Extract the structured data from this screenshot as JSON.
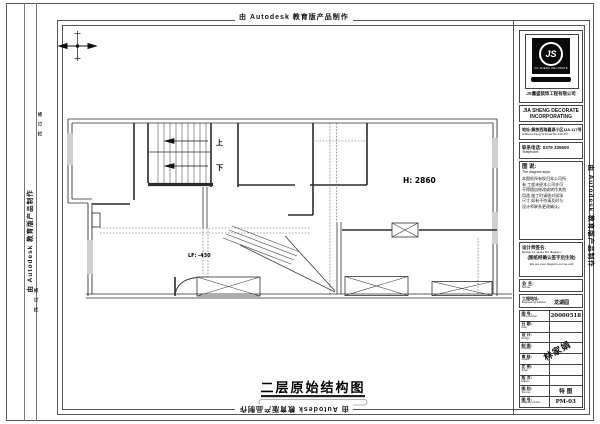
{
  "banner": {
    "autodesk": "由 Autodesk 教育版产品制作"
  },
  "margin": {
    "revision_top": "修 订 栏",
    "revision_bottom": "修 订 栏"
  },
  "plan": {
    "stair_up": "上",
    "stair_down": "下",
    "height_label": "H: 2860",
    "level_label": "LF: -430",
    "title": "二层原始结构图"
  },
  "title_block": {
    "logo": {
      "monogram": "JS",
      "sub": "JIA SHENG DECORATE",
      "company_cn": "JS嘉盛装饰工程有限公司"
    },
    "company_en_line1": "JIA SHENG DECORATE",
    "company_en_line2": "INCORPORATING",
    "address_cn": "地址:解放西路鑫源小区118-117号",
    "address_en": "Address:Fang W  Road No.118-117",
    "phone_cn": "联系电话: 0379 335500",
    "phone_en": "Telephone:",
    "notes_title_cn": "图 说:",
    "notes_title_en": "The diagram says:",
    "notes_lines": [
      "本图纸所有权归本公司所",
      "有,工程未经本公司许可",
      "不得擅自修改或转作其他",
      "用途,施工时请核对现场",
      "尺寸,如有不符请及时与",
      "设计师联系更改确认。"
    ],
    "sign_title_cn": "设计师签名:",
    "sign_title_en": "Design for about the diagram:",
    "sign_bold": "(图纸经确认签字后生效)",
    "sign_small": "We are over diagram our we and",
    "owner_label_cn": "业 主:",
    "owner_label_en": "Name:",
    "owner_value": "",
    "site_label_cn": "工程地址:",
    "site_label_en": "Engineering address:",
    "site_value": "龙湖园",
    "stamp": "林家娟",
    "table_rows": [
      {
        "cn": "图 号:",
        "en": "Plans number:",
        "value": "20000518"
      },
      {
        "cn": "日 期:",
        "en": "Date:",
        "value": ""
      },
      {
        "cn": "设 计:",
        "en": "Design:",
        "value": ""
      },
      {
        "cn": "制 图:",
        "en": "Drawing:",
        "value": ""
      },
      {
        "cn": "审 核:",
        "en": "Auditor:",
        "value": ""
      },
      {
        "cn": "比 例:",
        "en": "Scale:",
        "value": ""
      },
      {
        "cn": "版 次:",
        "en": "Edition:",
        "value": ""
      },
      {
        "cn": "图 别:",
        "en": "Species:",
        "value": "特 图"
      },
      {
        "cn": "图 号:",
        "en": "Diagram number:",
        "value": "PM-03"
      }
    ]
  }
}
